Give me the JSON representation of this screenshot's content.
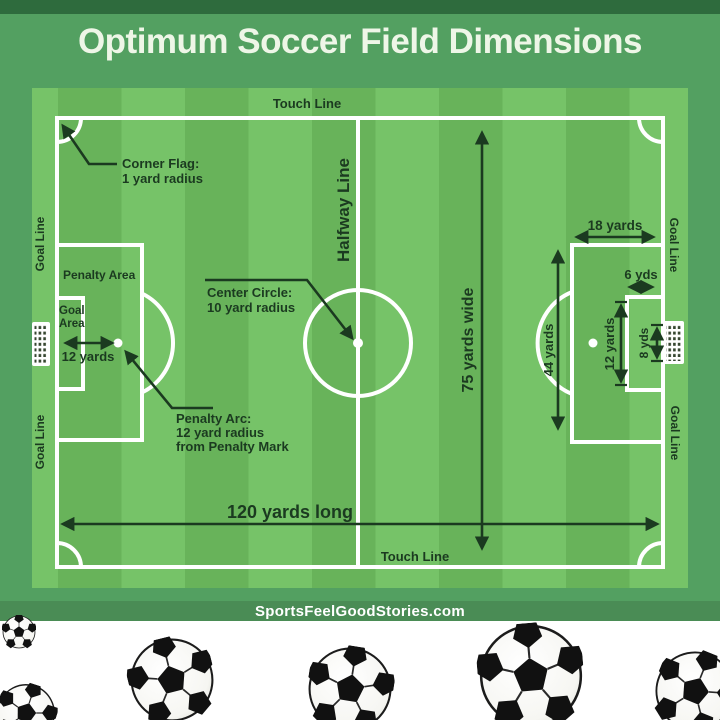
{
  "title": "Optimum Soccer Field Dimensions",
  "field": {
    "boundary_labels": {
      "touch_line_top": "Touch Line",
      "touch_line_bottom": "Touch Line",
      "goal_line_top_left": "Goal Line",
      "goal_line_bottom_left": "Goal Line",
      "goal_line_top_right": "Goal Line",
      "goal_line_bottom_right": "Goal Line",
      "halfway_line": "Halfway Line"
    },
    "annotations": {
      "corner_flag": {
        "line1": "Corner Flag:",
        "line2": "1 yard radius"
      },
      "center_circle": {
        "line1": "Center Circle:",
        "line2": "10 yard radius"
      },
      "penalty_arc": {
        "line1": "Penalty Arc:",
        "line2": "12 yard radius",
        "line3": "from Penalty Mark"
      },
      "penalty_area": "Penalty Area",
      "goal_area": {
        "line1": "Goal",
        "line2": "Area"
      }
    },
    "measurements": {
      "field_length": "120 yards long",
      "field_width": "75 yards wide",
      "penalty_mark_distance": "12 yards",
      "penalty_area_width": "44 yards",
      "penalty_area_depth": "18 yards",
      "goal_area_depth": "6 yds",
      "goal_area_width": "12 yards",
      "goal_width": "8 yds"
    }
  },
  "footer": {
    "website": "SportsFeelGoodStories.com"
  },
  "colors": {
    "background_green": "#53a061",
    "top_strip_green": "#2e6b3d",
    "footer_bar_green": "#4a8c55",
    "pitch_light_green": "#76c368",
    "pitch_dark_green": "#68b35a",
    "line_white": "#ffffff",
    "label_dark_green": "#1b3a20"
  }
}
